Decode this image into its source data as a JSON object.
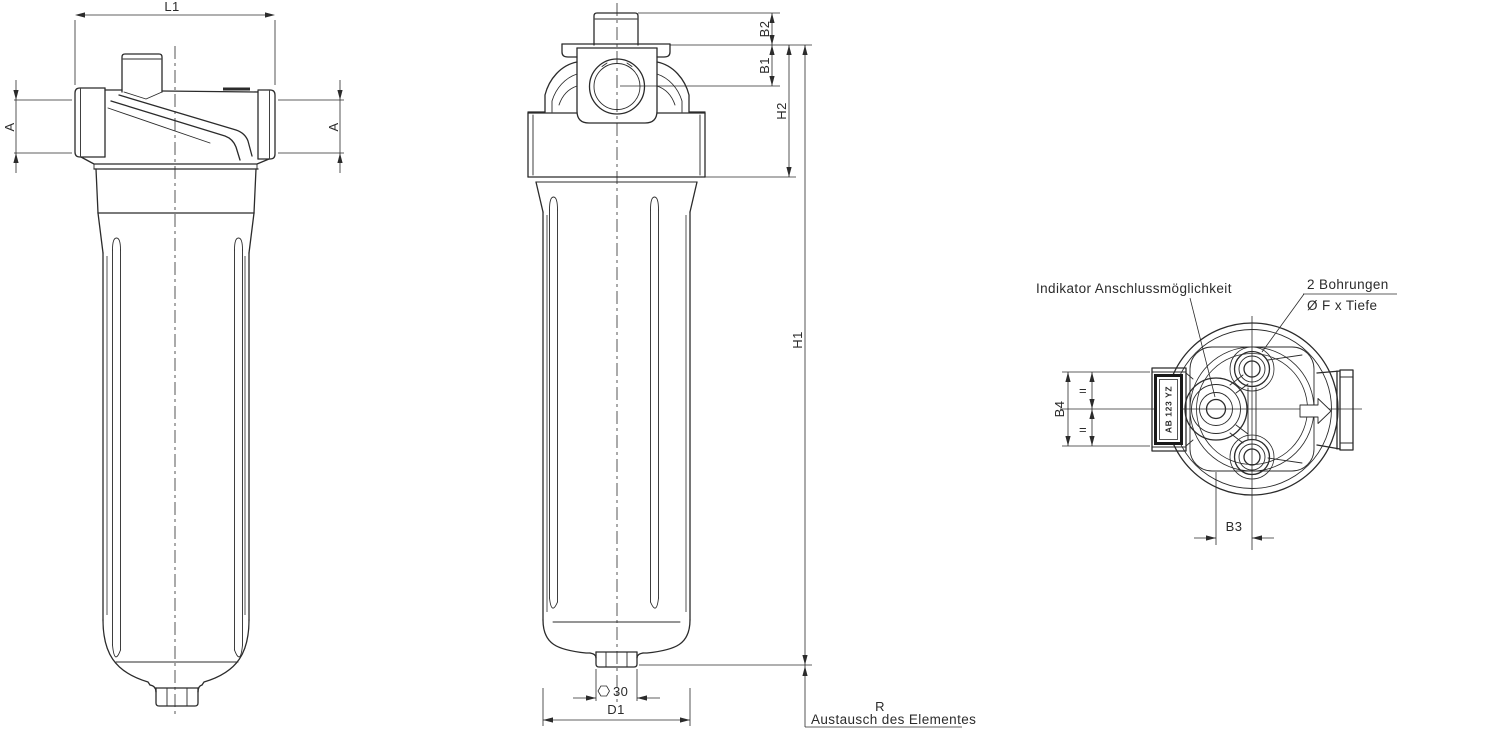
{
  "drawing": {
    "colors": {
      "line": "#2b2b2b",
      "background": "#ffffff"
    },
    "dimensions": {
      "l1": "L1",
      "a_left": "A",
      "a_right": "A",
      "b2": "B2",
      "b1": "B1",
      "h2": "H2",
      "h1": "H1",
      "hex_size": "30",
      "d1": "D1",
      "b4": "B4",
      "b3": "B3",
      "equal_upper": "=",
      "equal_lower": "=",
      "r": "R"
    },
    "annotations": {
      "indicator": "Indikator Anschlussmöglichkeit",
      "bores_title": "2 Bohrungen",
      "bores_spec": "Ø F x Tiefe",
      "replacement": "Austausch des Elementes",
      "nameplate": "AB 123 YZ"
    }
  }
}
